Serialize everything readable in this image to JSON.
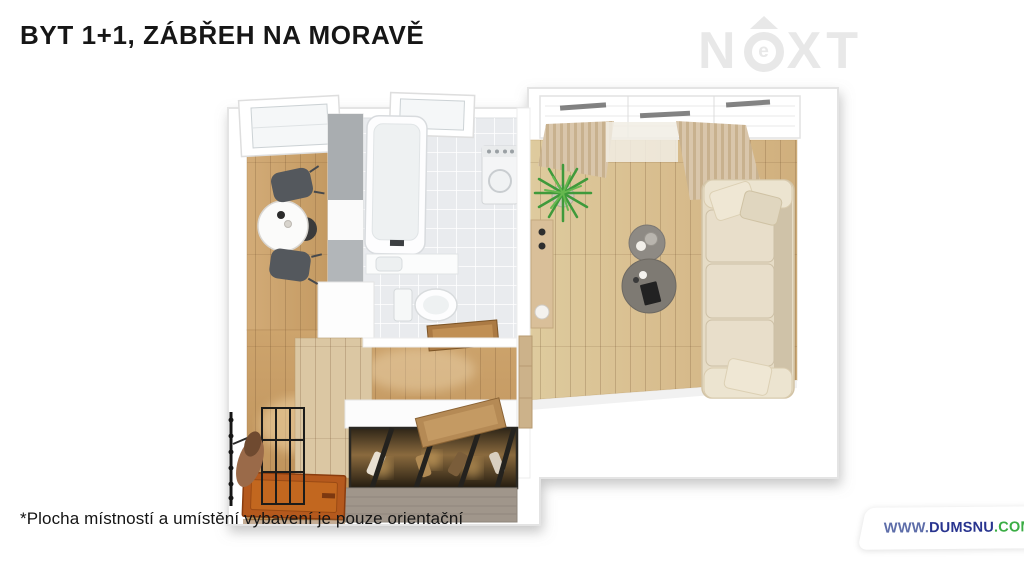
{
  "header": {
    "title": "BYT 1+1, ZÁBŘEH NA MORAVĚ"
  },
  "logo": {
    "n": "N",
    "e": "e",
    "xt": "XT",
    "color": "#e8e8e8"
  },
  "floorplan": {
    "description": "3D top-down render of a 1+1 apartment",
    "rooms": [
      {
        "name": "kitchen",
        "floor": "wood",
        "items": [
          "window",
          "round-dining-table",
          "two-dark-chairs",
          "cabinet-run",
          "counter"
        ]
      },
      {
        "name": "bathroom",
        "floor": "light-tile",
        "items": [
          "window",
          "bathtub",
          "washbasin-counter",
          "toilet",
          "washing-machine"
        ]
      },
      {
        "name": "living-room",
        "floor": "light-wood",
        "items": [
          "panoramic-window-with-curtains",
          "potted-plant",
          "wall-console",
          "two-round-coffee-tables",
          "cream-sofa-with-pillows"
        ]
      },
      {
        "name": "hallway",
        "floor": "wood",
        "items": [
          "orange-entry-door-open",
          "coat-hooks-with-jacket",
          "black-metal-rack",
          "glass-top-shoe-wardrobe",
          "wooden-trays"
        ]
      }
    ],
    "colors": {
      "wood_floor": "#d2b186",
      "tile_floor": "#e9ebee",
      "walls": "#ffffff",
      "sofa": "#e8dfca",
      "entry_door": "#b5591d",
      "plant": "#3f9a3b"
    }
  },
  "footer": {
    "disclaimer": "*Plocha místností a umístění vybavení je pouze orientační",
    "watermark": {
      "www": "WWW.",
      "domain": "DUMSNU",
      "tld": ".COM",
      "www_color": "#5d6da9",
      "domain_color": "#28348f",
      "tld_color": "#3aad44"
    }
  }
}
